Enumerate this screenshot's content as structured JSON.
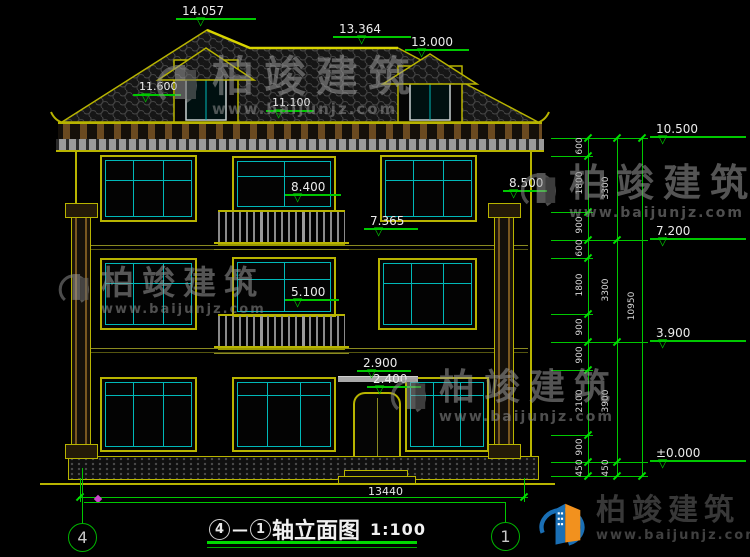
{
  "brand": {
    "name": "柏竣建筑",
    "url": "www.baijunjz.com"
  },
  "title": {
    "axis_start": "4",
    "dash": "—",
    "axis_end": "1",
    "name": "轴立面图",
    "scale": "1:100"
  },
  "axes": {
    "left": "4",
    "right": "1"
  },
  "levels": {
    "ridge": "14.057",
    "ridge_rear": "13.364",
    "dormer": "13.000",
    "eave_left": "11.600",
    "eave_main": "11.100",
    "pilaster_top": "8.500",
    "balcony3": "8.400",
    "band3": "7.365",
    "balcony2": "5.100",
    "canopy": "2.900",
    "door_top": "2.400",
    "right": [
      "10.500",
      "7.200",
      "3.900",
      "±0.000"
    ]
  },
  "dims": {
    "segments": [
      "600",
      "1800",
      "900",
      "600",
      "1800",
      "900",
      "900",
      "2100",
      "900",
      "450"
    ],
    "floors": [
      "3300",
      "3300",
      "3900",
      "450"
    ],
    "total": "10950",
    "width": "13440"
  }
}
